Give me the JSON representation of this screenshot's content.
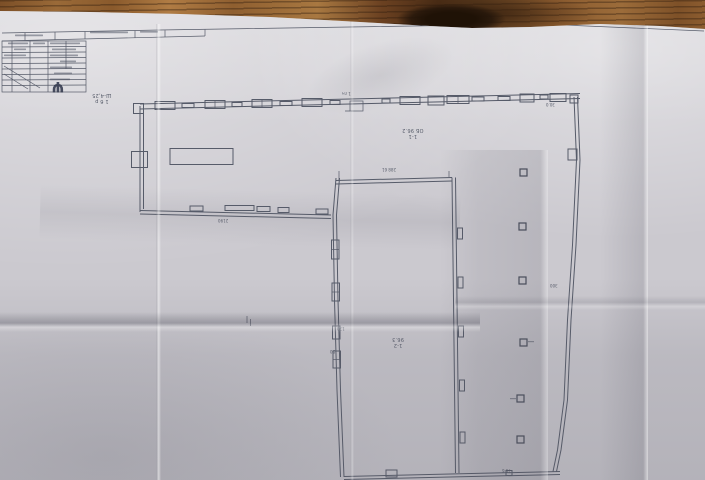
{
  "palette": {
    "ink": "#565b69",
    "ink_dark": "#474c5a",
    "paper": "#cbc9cf"
  },
  "labels": {
    "corner_note": {
      "line1": "1 б р",
      "line2": "Ш-4,25"
    },
    "section_mark": {
      "line1": "1-1",
      "line2": "ОБ 96.2"
    },
    "hall_mark": {
      "line1": "1-2",
      "line2": "96.3"
    },
    "top_wall_note": "1 пч",
    "dims": {
      "wing_bottom": "2190",
      "hall_top": "288 61",
      "right_top": "30.0",
      "right_mid": "300",
      "left_wall_a": "130",
      "left_wall_b": "50",
      "bottom_right": "75 б"
    }
  },
  "title_block": {
    "logo_glyph": "Ψ"
  }
}
